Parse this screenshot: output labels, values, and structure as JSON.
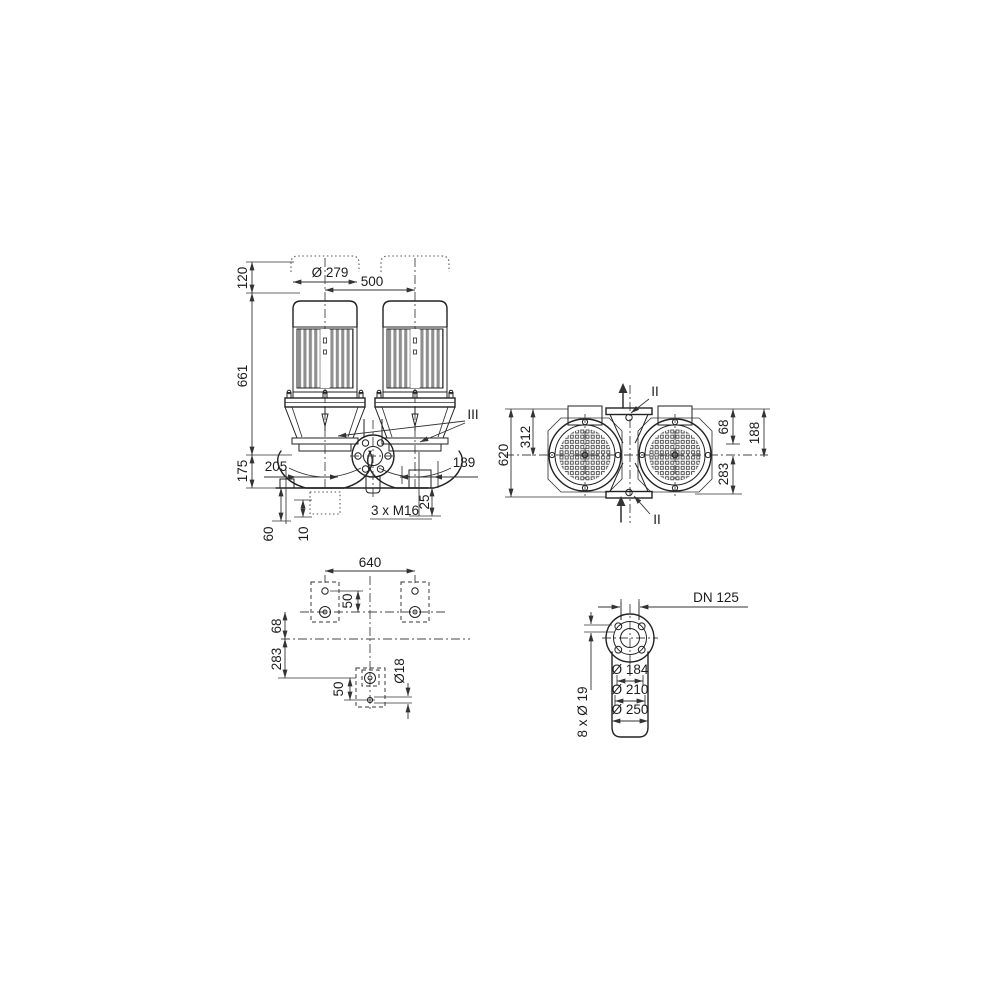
{
  "drawing": {
    "kind": "technical-dimension-drawing",
    "colors": {
      "line": "#222222",
      "dimension": "#333333",
      "fins": "#8f8f8f",
      "background": "#ffffff"
    },
    "views": {
      "front": {
        "section_label": "III",
        "dim_clearance_above_motor": "120",
        "dim_motor_diameter": "Ø 279",
        "dim_motor_spacing": "500",
        "dim_height": "661",
        "dim_port_axis_height": "175",
        "dim_offset_left": "205",
        "dim_offset_right": "189",
        "dim_anchor_thread": "3 x M16",
        "dim_thread_depth": "25",
        "dim_base_depth": "60",
        "dim_grout": "10"
      },
      "plan": {
        "dim_overall_width": "620",
        "dim_edge_to_axis": "312",
        "dim_axis_offset": "68",
        "dim_edge_offset": "188",
        "dim_lower_offset": "283",
        "section_label_top": "II",
        "section_label_bottom": "II"
      },
      "foundation": {
        "dim_bolt_span": "640",
        "dim_hole_offset_upper": "50",
        "dim_axis_offset": "68",
        "dim_lower_offset": "283",
        "dim_hole_offset_lower": "50",
        "dim_hole_diameter": "Ø18"
      },
      "flange": {
        "dim_nominal_bore": "DN 125",
        "dim_raised_face": "Ø 184",
        "dim_bolt_circle": "Ø 210",
        "dim_outer_diameter": "Ø 250",
        "dim_bolt_holes": "8 x Ø 19"
      }
    }
  }
}
